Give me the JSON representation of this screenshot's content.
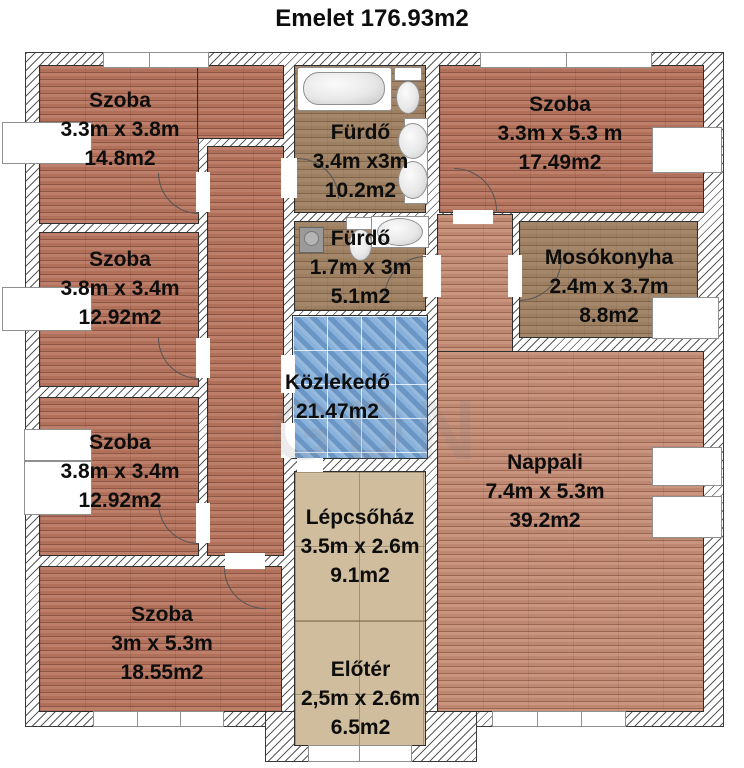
{
  "title": "Emelet 176.93m2",
  "watermark": "GDN",
  "rooms": [
    {
      "name": "Szoba",
      "dims": "3.3m x 3.8m",
      "area": "14.8m2"
    },
    {
      "name": "Fürdő",
      "dims": "3.4m x3m",
      "area": "10.2m2"
    },
    {
      "name": "Szoba",
      "dims": "3.3m x 5.3 m",
      "area": "17.49m2"
    },
    {
      "name": "Szoba",
      "dims": "3.8m x 3.4m",
      "area": "12.92m2"
    },
    {
      "name": "Fürdő",
      "dims": "1.7m x 3m",
      "area": "5.1m2"
    },
    {
      "name": "Mosókonyha",
      "dims": "2.4m x 3.7m",
      "area": "8.8m2"
    },
    {
      "name": "Szoba",
      "dims": "3.8m x 3.4m",
      "area": "12.92m2"
    },
    {
      "name": "Közlekedő",
      "dims": "",
      "area": "21.47m2"
    },
    {
      "name": "Nappali",
      "dims": "7.4m x 5.3m",
      "area": "39.2m2"
    },
    {
      "name": "Szoba",
      "dims": "3m x 5.3m",
      "area": "18.55m2"
    },
    {
      "name": "Lépcsőház",
      "dims": "3.5m x 2.6m",
      "area": "9.1m2"
    },
    {
      "name": "Előtér",
      "dims": "2,5m x 2.6m",
      "area": "6.5m2"
    }
  ],
  "fixtures": [
    "bathtub",
    "toilet",
    "sink",
    "washing-machine"
  ],
  "colors": {
    "parquet": "#b1705a",
    "parquet_light": "#c08a74",
    "tile_brown": "#9d8062",
    "tile_beige": "#cfbd9d",
    "tile_blue": "#7aa5d2",
    "wall_hatch": "#505050",
    "text": "#0d0d0d"
  }
}
